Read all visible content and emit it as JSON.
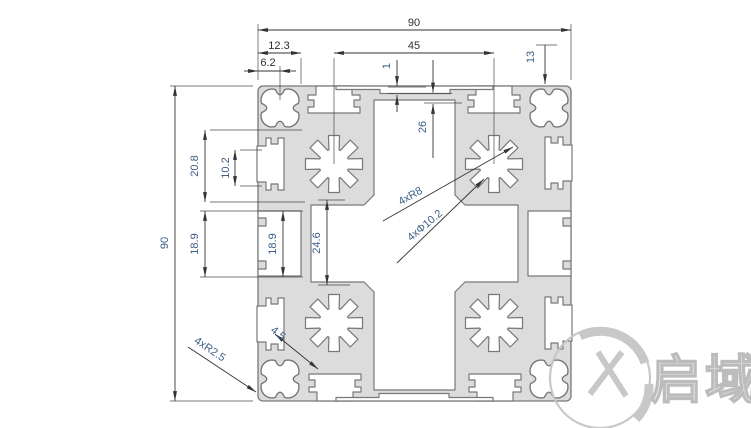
{
  "drawing": {
    "dims": {
      "d90_top": "90",
      "d12_3": "12.3",
      "d6_2": "6.2",
      "d45": "45",
      "d1": "1",
      "d26": "26",
      "d13": "13",
      "d90_left": "90",
      "d20_8": "20.8",
      "d10_2": "10.2",
      "d18_9_outer": "18.9",
      "d18_9_inner": "18.9",
      "d24_6": "24.6",
      "d4_5": "4.5"
    },
    "callouts": {
      "lobe_radius": "4xR8",
      "hole_diameter": "4xΦ10.2",
      "corner_radius": "4xR2.5"
    },
    "watermark": {
      "brand": "启域"
    },
    "colors": {
      "body_fill": "#dcdcdd",
      "outline": "#77787a",
      "dim_line": "#333333",
      "rotated_text": "#3d5e86",
      "watermark": "#c0c0c0"
    }
  }
}
